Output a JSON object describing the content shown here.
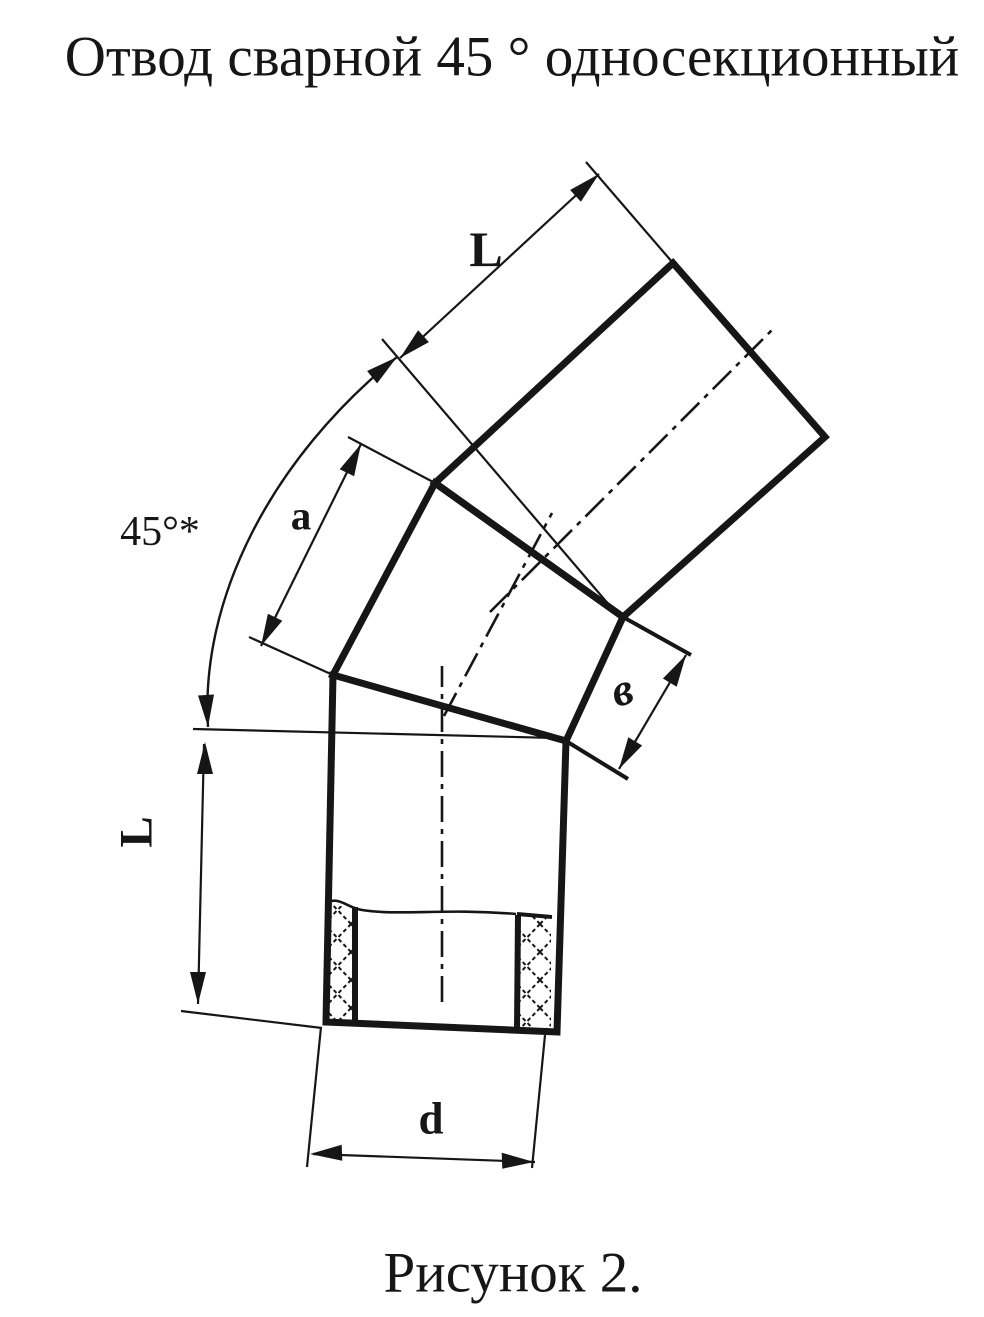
{
  "title": "Отвод сварной 45 ° односекционный",
  "caption": "Рисунок 2.",
  "dimensions": {
    "upper_segment_length": "L",
    "bend_angle": "45°*",
    "section_outer_side": "a",
    "section_inner_side": "в",
    "lower_segment_length": "L",
    "pipe_diameter": "d"
  },
  "colors": {
    "ink": "#161616",
    "paper": "#ffffff"
  }
}
